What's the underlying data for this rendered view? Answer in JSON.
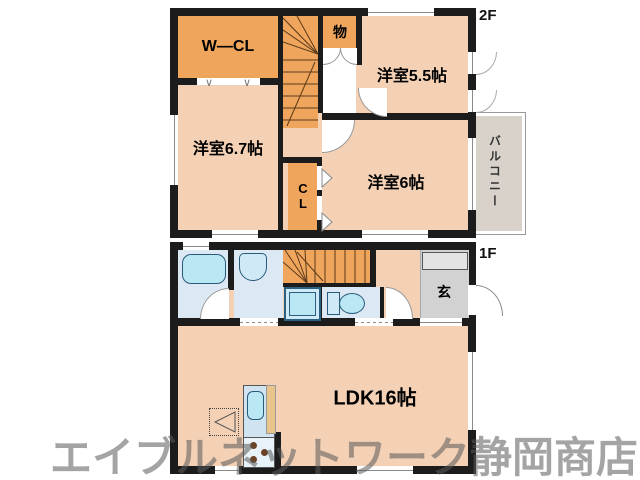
{
  "floor2": {
    "label": "2F",
    "rooms": {
      "wcl": "W—CL",
      "storage": "物",
      "bedroom55": "洋室5.5帖",
      "bedroom67": "洋室6.7帖",
      "closet": "CL",
      "bedroom6": "洋室6帖",
      "balcony": "バルコニー"
    }
  },
  "floor1": {
    "label": "1F",
    "rooms": {
      "entrance": "玄",
      "ldk": "LDK16帖"
    }
  },
  "watermark": "エイブルネットワーク静岡商店",
  "icons": {
    "folding_door": "∨"
  },
  "colors": {
    "wall": "#1c1c1c",
    "room_floor": "#f4d1b5",
    "closet_stairs_orange": "#f0a55c",
    "wet_area_floor": "#dce9f5",
    "fixture_cyan": "#b9e7f3",
    "entrance_gray": "#d2d2d2",
    "balcony_gray": "#d8d2cb",
    "watermark_gray": "#5a5a5a"
  }
}
